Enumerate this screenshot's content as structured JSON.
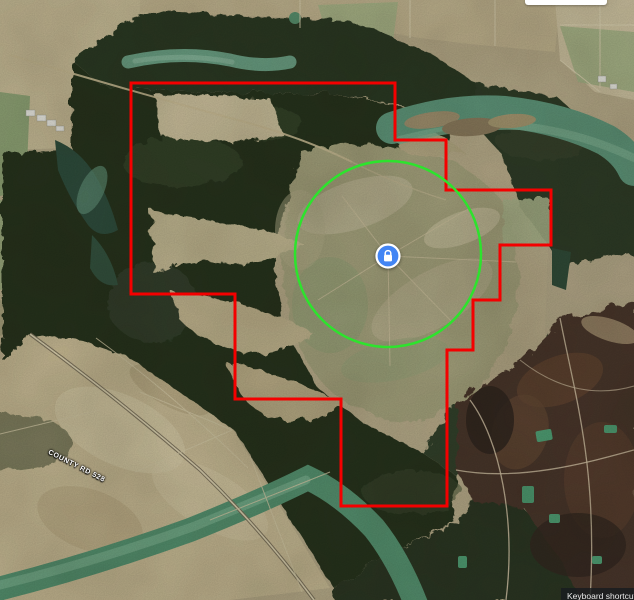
{
  "labels": {
    "road": "COUNTY RD 528",
    "keyboard_shortcuts": "Keyboard shortcuts"
  },
  "overlay": {
    "boundary": {
      "color": "#f40000",
      "stroke_width": 3,
      "points": [
        [
          131,
          83
        ],
        [
          395,
          83
        ],
        [
          395,
          140
        ],
        [
          446,
          140
        ],
        [
          446,
          190
        ],
        [
          551,
          190
        ],
        [
          551,
          245
        ],
        [
          500,
          245
        ],
        [
          500,
          300
        ],
        [
          473,
          300
        ],
        [
          473,
          350
        ],
        [
          447,
          350
        ],
        [
          447,
          506
        ],
        [
          341,
          506
        ],
        [
          341,
          399
        ],
        [
          235,
          399
        ],
        [
          235,
          294
        ],
        [
          131,
          294
        ]
      ]
    },
    "radius_circle": {
      "color": "#2de32d",
      "stroke_width": 2.5,
      "cx": 388,
      "cy": 254,
      "r": 93
    },
    "marker": {
      "cx": 388,
      "cy": 256,
      "fill": "#4285f4",
      "ring_color": "#ffffff",
      "icon": "lock-icon"
    }
  },
  "map_colors": {
    "water": "#5f967a",
    "forest": "#27331f",
    "farmland": "#c8ba94",
    "plowed_field": "#4a362a"
  }
}
